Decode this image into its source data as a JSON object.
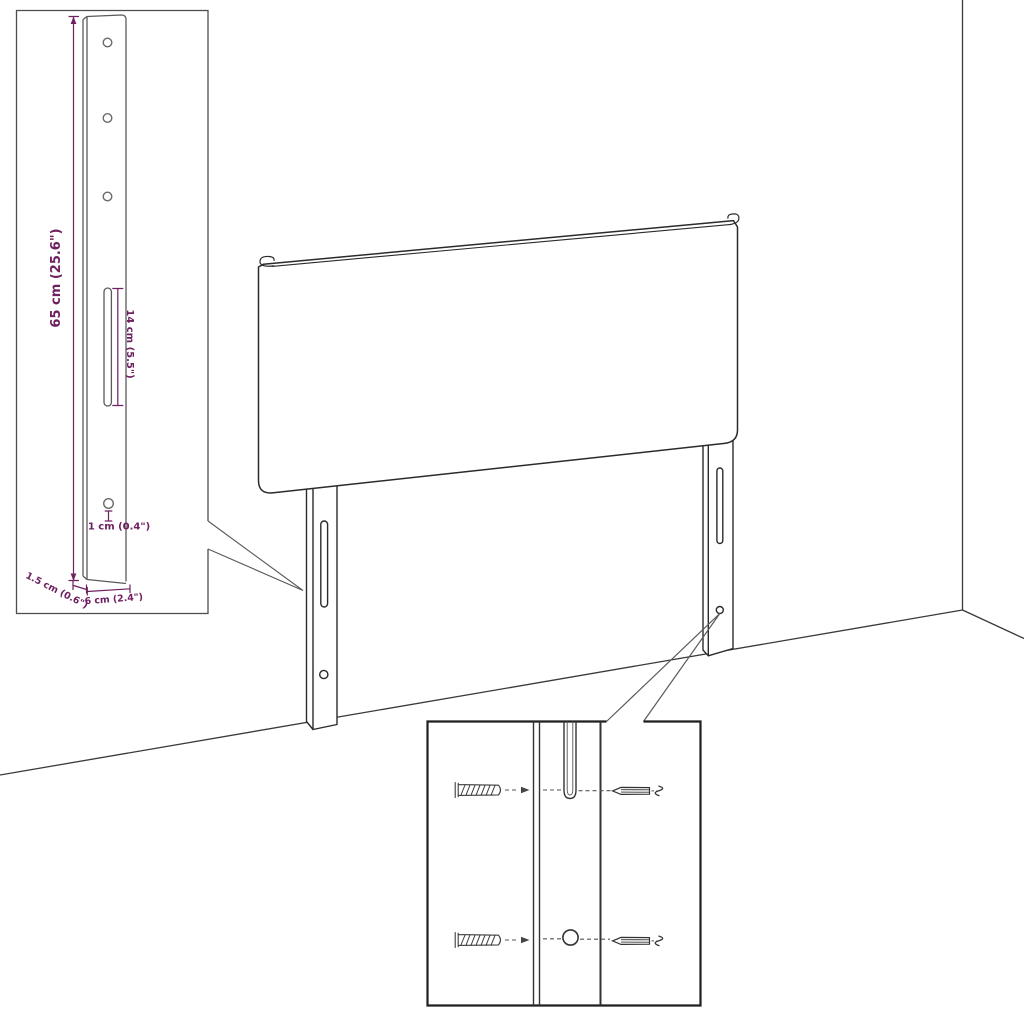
{
  "diagram": {
    "kind": "furniture-assembly-diagram",
    "subject": "headboard with two wall-mount leg brackets in a room corner"
  },
  "colors": {
    "background": "#ffffff",
    "line": "#2b2b2b",
    "dimension_accent": "#6E2060",
    "inset_border": "#4d4d4d"
  },
  "bracket_inset": {
    "labels": {
      "height": "65 cm (25.6\")",
      "slot": "14 cm (5.5\")",
      "hole": "1 cm (0.4\")",
      "depth": "1.5 cm (0.6\")",
      "width": "6 cm (2.4\")"
    },
    "holes_visible": 4,
    "slots_visible": 1
  },
  "hardware_inset": {
    "icons": [
      "wall-plug-icon",
      "screw-icon",
      "wall-plug-icon",
      "screw-icon"
    ],
    "rows": 2
  },
  "scene_icons": [
    "headboard",
    "left-leg-bracket",
    "right-leg-bracket",
    "wall-corner",
    "floor-line"
  ]
}
